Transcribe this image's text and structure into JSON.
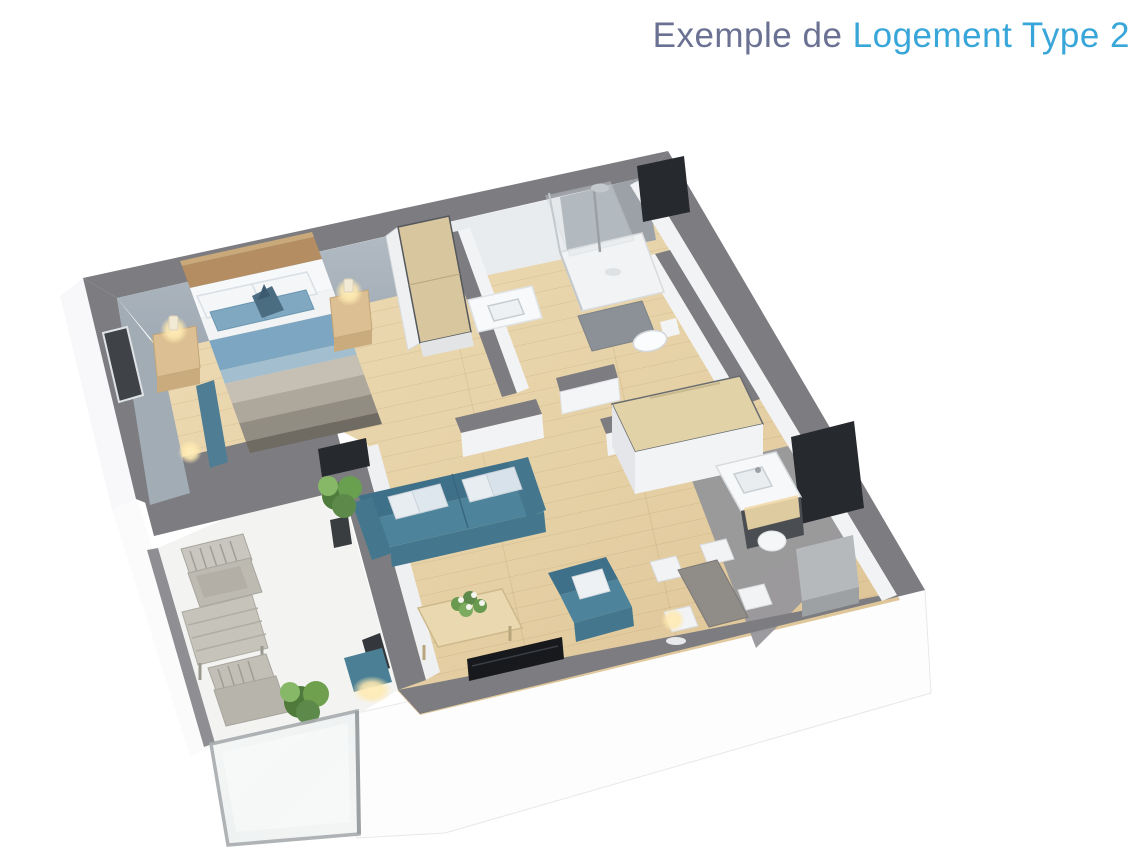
{
  "title": {
    "prefix": "Exemple de ",
    "highlight": "Logement Type 2"
  },
  "palette": {
    "page-bg": "#ffffff",
    "title-prefix": "#6b7192",
    "title-accent": "#38a6d9",
    "wall-top": "#7c7c81",
    "wall-blue": "#a9b3bc",
    "shower-wall": "#9ba1a6",
    "niche-dark": "#26292d",
    "floor-wood-light": "#eedcb6",
    "floor-wood-dark": "#dcc294",
    "floor-kitchen": "#97979b",
    "floor-terrace": "#f3f4f2",
    "sofa-dark": "#3f7089",
    "sofa-mid": "#4d849b",
    "duvet-blue": "#7ca6c2",
    "headboard-wood": "#b48e62",
    "wood-furniture": "#e2d2a8",
    "terrace-wood": "#c2bfb7",
    "plant-green": "#5d8a4a",
    "lamp-glow": "#ffe9b0"
  },
  "scene": {
    "type": "isometric-apartment-floor-plan",
    "rooms": [
      {
        "name": "bedroom",
        "furniture": [
          "double-bed",
          "headboard",
          "nightstand-left",
          "nightstand-right",
          "table-lamp-left",
          "table-lamp-right",
          "wardrobe",
          "curtain",
          "floor-lamp"
        ]
      },
      {
        "name": "bathroom",
        "furniture": [
          "walk-in-shower",
          "shower-tray",
          "bath-mat",
          "toilet",
          "vanity-sink"
        ]
      },
      {
        "name": "living-room",
        "furniture": [
          "sofa",
          "armchair",
          "coffee-table",
          "flower-bouquet",
          "potted-plant",
          "tv-screen",
          "floor-pouf",
          "floor-lamp"
        ]
      },
      {
        "name": "kitchen",
        "furniture": [
          "kitchen-island",
          "sink-counter",
          "cabinet"
        ]
      },
      {
        "name": "dining-area",
        "furniture": [
          "dining-table",
          "dining-chairs",
          "floor-lamp"
        ]
      },
      {
        "name": "terrace",
        "furniture": [
          "wooden-armchair-1",
          "wooden-armchair-2",
          "wooden-table",
          "potted-plant",
          "glass-balustrade"
        ]
      }
    ]
  }
}
